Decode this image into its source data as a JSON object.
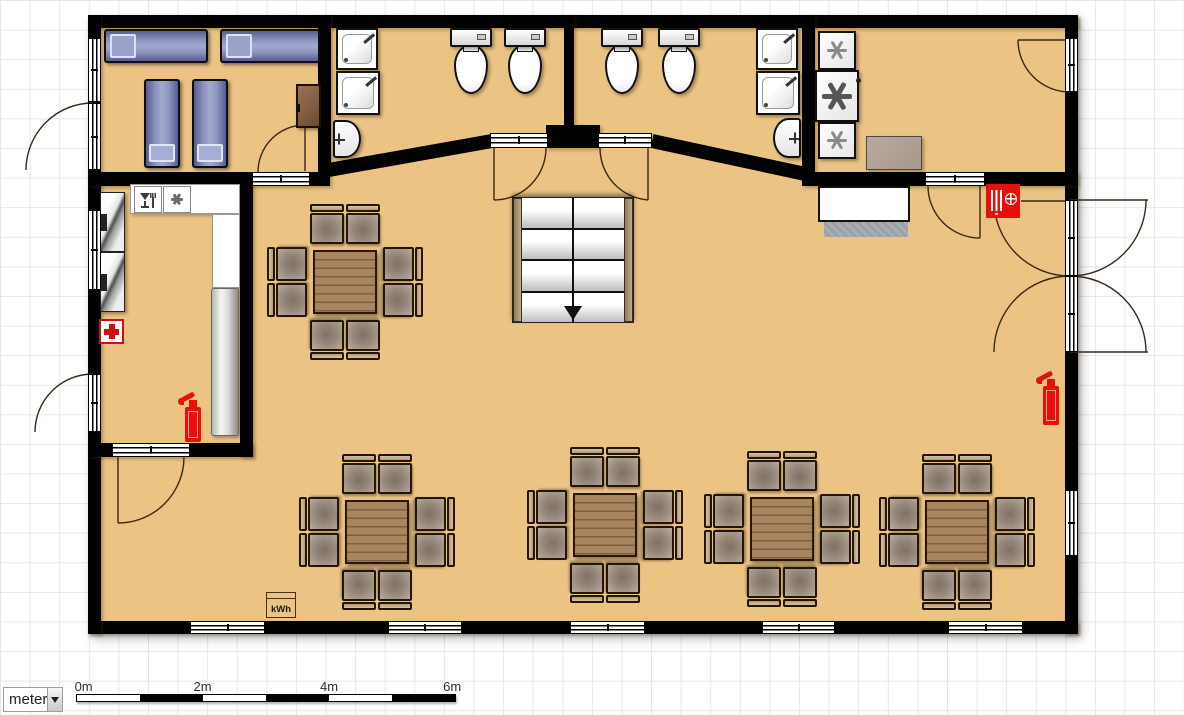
{
  "unit_selector": {
    "value": "meter"
  },
  "scale_bar": {
    "labels": [
      "0m",
      "2m",
      "4m",
      "6m"
    ],
    "unit": "meter",
    "segment_count": 6,
    "meters_per_segment": 1,
    "total_meters": 6
  },
  "energy_meter_label": "kWh",
  "colors": {
    "floor": "#ebc383",
    "wall": "#000000",
    "grid": "#e3e7ea",
    "safety_red": "#e8100c",
    "table_wood": "#a8845f",
    "chair_frame": "#b49a76",
    "bed_blue": "#8d93bd",
    "stair_stringer": "#b29a76"
  },
  "rooms": {
    "bedroom_top_left": {
      "items": [
        "sofa-bed",
        "sofa-bed",
        "single-bed",
        "single-bed",
        "cabinet"
      ]
    },
    "bathroom_left": {
      "items": [
        "shower",
        "shower",
        "wash-basin",
        "toilet",
        "toilet"
      ]
    },
    "bathroom_right": {
      "items": [
        "toilet",
        "toilet",
        "shower",
        "shower",
        "wash-basin"
      ]
    },
    "laundry_top_right": {
      "items": [
        "washing-machine",
        "washing-machine",
        "washing-machine",
        "counter-box"
      ]
    },
    "kitchen_left": {
      "items": [
        "counter",
        "dishwasher-tile",
        "freezer-tile",
        "shelf-unit",
        "shelf-unit",
        "worktop",
        "first-aid-kit",
        "fire-extinguisher"
      ]
    },
    "main_hall": {
      "items": [
        "staircase-down",
        "dining-table-with-8-chairs x5",
        "crossed-serving-counter",
        "floor-mat",
        "fire-hose-reel",
        "fire-extinguisher",
        "energy-meter-kwh"
      ]
    }
  },
  "safety_equipment": {
    "fire_extinguishers": 2,
    "fire_hose_reels": 1,
    "first_aid_kits": 1
  },
  "furniture_layout": {
    "dining_tables": [
      {
        "cx": 345,
        "cy": 282
      },
      {
        "cx": 377,
        "cy": 532
      },
      {
        "cx": 605,
        "cy": 525
      },
      {
        "cx": 782,
        "cy": 529
      },
      {
        "cx": 957,
        "cy": 532
      }
    ],
    "chairs_per_table": 8,
    "toilets": [
      {
        "x": 450,
        "y": 28
      },
      {
        "x": 504,
        "y": 28
      },
      {
        "x": 601,
        "y": 28
      },
      {
        "x": 658,
        "y": 28
      }
    ],
    "bottom_windows": [
      {
        "x": 190,
        "w": 75
      },
      {
        "x": 388,
        "w": 74
      },
      {
        "x": 570,
        "w": 75
      },
      {
        "x": 762,
        "w": 73
      },
      {
        "x": 948,
        "w": 75
      }
    ]
  }
}
